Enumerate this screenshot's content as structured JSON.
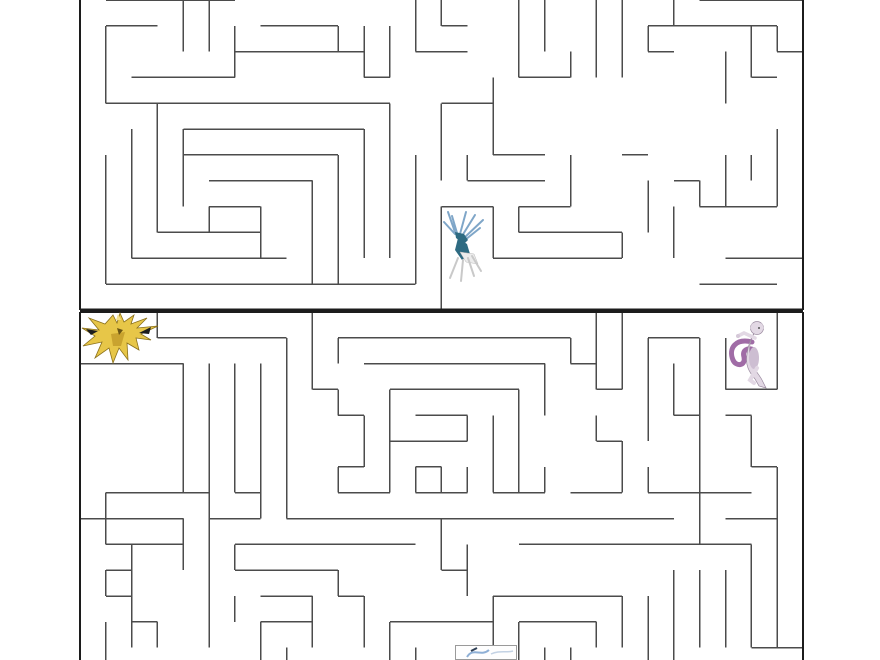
{
  "page": {
    "description": "Pokemon maze puzzle worksheet, two mazes stacked vertically, cropped at top and bottom",
    "background_color": "#ffffff",
    "wall_color": "#4b4b4b",
    "border_color": "#1c1c1c",
    "wall_width": 1.5,
    "border_width": 2.2
  },
  "maze_top": {
    "origin_x": 80,
    "origin_y": 0,
    "cell": 25.82,
    "cols": 28,
    "rows": 12,
    "note": "top edge of maze cut off by viewport",
    "borders": {
      "h": [
        [
          12,
          0,
          28
        ]
      ],
      "v": [
        [
          0,
          0,
          12
        ],
        [
          28,
          0,
          12
        ]
      ]
    },
    "h_walls": [
      [
        0,
        1,
        6
      ],
      [
        0,
        24,
        28
      ],
      [
        1,
        1,
        3
      ],
      [
        1,
        7,
        10
      ],
      [
        1,
        14,
        15
      ],
      [
        1,
        22,
        27
      ],
      [
        2,
        6,
        11
      ],
      [
        2,
        13,
        15
      ],
      [
        2,
        22,
        23
      ],
      [
        2,
        27,
        28
      ],
      [
        3,
        2,
        6
      ],
      [
        3,
        11,
        12
      ],
      [
        3,
        17,
        19
      ],
      [
        3,
        26,
        27
      ],
      [
        4,
        1,
        12
      ],
      [
        4,
        14,
        16
      ],
      [
        5,
        4,
        11
      ],
      [
        6,
        4,
        10
      ],
      [
        6,
        16,
        18
      ],
      [
        6,
        21,
        22
      ],
      [
        7,
        5,
        9
      ],
      [
        7,
        15,
        18
      ],
      [
        7,
        23,
        24
      ],
      [
        8,
        5,
        7
      ],
      [
        8,
        14,
        16
      ],
      [
        8,
        17,
        19
      ],
      [
        8,
        24,
        27
      ],
      [
        9,
        3,
        7
      ],
      [
        9,
        17,
        21
      ],
      [
        10,
        2,
        8
      ],
      [
        10,
        16,
        21
      ],
      [
        10,
        25,
        28
      ],
      [
        11,
        1,
        13
      ],
      [
        11,
        24,
        27
      ]
    ],
    "v_walls": [
      [
        1,
        1,
        4
      ],
      [
        1,
        6,
        11
      ],
      [
        2,
        5,
        10
      ],
      [
        3,
        4,
        9
      ],
      [
        4,
        0,
        2
      ],
      [
        4,
        5,
        8
      ],
      [
        5,
        0,
        2
      ],
      [
        5,
        8,
        9
      ],
      [
        6,
        1,
        3
      ],
      [
        7,
        8,
        10
      ],
      [
        9,
        7,
        11
      ],
      [
        10,
        1,
        2
      ],
      [
        10,
        6,
        11
      ],
      [
        11,
        1,
        3
      ],
      [
        11,
        5,
        10
      ],
      [
        12,
        1,
        3
      ],
      [
        12,
        4,
        10
      ],
      [
        13,
        0,
        2
      ],
      [
        13,
        6,
        11
      ],
      [
        14,
        0,
        1
      ],
      [
        14,
        4,
        7
      ],
      [
        14,
        8,
        12
      ],
      [
        15,
        6,
        7
      ],
      [
        16,
        3,
        6
      ],
      [
        16,
        8,
        10
      ],
      [
        17,
        0,
        3
      ],
      [
        17,
        8,
        9
      ],
      [
        18,
        0,
        2
      ],
      [
        19,
        2,
        3
      ],
      [
        19,
        6,
        8
      ],
      [
        20,
        0,
        3
      ],
      [
        21,
        0,
        3
      ],
      [
        21,
        9,
        10
      ],
      [
        22,
        1,
        2
      ],
      [
        22,
        7,
        9
      ],
      [
        23,
        0,
        1
      ],
      [
        23,
        8,
        10
      ],
      [
        24,
        7,
        8
      ],
      [
        25,
        2,
        4
      ],
      [
        25,
        6,
        8
      ],
      [
        26,
        1,
        3
      ],
      [
        26,
        6,
        7
      ],
      [
        27,
        1,
        2
      ],
      [
        27,
        5,
        8
      ]
    ]
  },
  "maze_bottom": {
    "origin_x": 80,
    "origin_y": 312,
    "cell": 25.82,
    "cols": 28,
    "rows": 13.6,
    "note": "bottom edge of maze cut off by viewport",
    "borders": {
      "h": [
        [
          0,
          0,
          28
        ]
      ],
      "v": [
        [
          0,
          0,
          13.6
        ],
        [
          28,
          0,
          13.6
        ]
      ]
    },
    "h_walls": [
      [
        1,
        3,
        8
      ],
      [
        1,
        10,
        19
      ],
      [
        1,
        22,
        24
      ],
      [
        2,
        0,
        4
      ],
      [
        2,
        11,
        18
      ],
      [
        2,
        19,
        20
      ],
      [
        3,
        9,
        10
      ],
      [
        3,
        12,
        17
      ],
      [
        3,
        20,
        21
      ],
      [
        3,
        25,
        27
      ],
      [
        4,
        10,
        11
      ],
      [
        4,
        13,
        15
      ],
      [
        4,
        23,
        24
      ],
      [
        4,
        25,
        26
      ],
      [
        5,
        12,
        15
      ],
      [
        5,
        20,
        21
      ],
      [
        6,
        10,
        11
      ],
      [
        6,
        13,
        14
      ],
      [
        6,
        26,
        27
      ],
      [
        7,
        1,
        5
      ],
      [
        7,
        6,
        7
      ],
      [
        7,
        10,
        12
      ],
      [
        7,
        13,
        15
      ],
      [
        7,
        16,
        18
      ],
      [
        7,
        19,
        21
      ],
      [
        7,
        22,
        26
      ],
      [
        8,
        0,
        4
      ],
      [
        8,
        5,
        7
      ],
      [
        8,
        8,
        23
      ],
      [
        8,
        25,
        27
      ],
      [
        9,
        1,
        4
      ],
      [
        9,
        6,
        13
      ],
      [
        9,
        17,
        26
      ],
      [
        10,
        1,
        2
      ],
      [
        10,
        6,
        10
      ],
      [
        10,
        14,
        15
      ],
      [
        11,
        1,
        2
      ],
      [
        11,
        7,
        9
      ],
      [
        11,
        10,
        11
      ],
      [
        11,
        16,
        21
      ],
      [
        12,
        2,
        3
      ],
      [
        12,
        7,
        9
      ],
      [
        12,
        12,
        16
      ],
      [
        12,
        17,
        20
      ],
      [
        13,
        26,
        28
      ]
    ],
    "v_walls": [
      [
        1,
        7,
        9
      ],
      [
        1,
        10,
        11
      ],
      [
        1,
        12,
        13.6
      ],
      [
        2,
        9,
        13
      ],
      [
        3,
        0,
        1
      ],
      [
        3,
        12,
        13
      ],
      [
        4,
        2,
        7
      ],
      [
        4,
        8,
        10
      ],
      [
        5,
        2,
        13
      ],
      [
        6,
        2,
        7
      ],
      [
        6,
        9,
        10
      ],
      [
        6,
        11,
        12
      ],
      [
        7,
        2,
        8
      ],
      [
        7,
        12,
        13.6
      ],
      [
        8,
        1,
        8
      ],
      [
        8,
        13,
        13.6
      ],
      [
        9,
        0,
        3
      ],
      [
        9,
        11,
        13
      ],
      [
        10,
        1,
        2
      ],
      [
        10,
        3,
        4
      ],
      [
        10,
        6,
        7
      ],
      [
        10,
        10,
        11
      ],
      [
        11,
        4,
        6
      ],
      [
        11,
        11,
        13
      ],
      [
        12,
        3,
        7
      ],
      [
        12,
        12,
        13.6
      ],
      [
        13,
        6,
        7
      ],
      [
        13,
        13,
        13.6
      ],
      [
        14,
        6,
        7
      ],
      [
        14,
        8,
        10
      ],
      [
        15,
        4,
        5
      ],
      [
        15,
        6,
        7
      ],
      [
        15,
        9,
        11
      ],
      [
        16,
        4,
        7
      ],
      [
        16,
        11,
        13.6
      ],
      [
        17,
        3,
        7
      ],
      [
        17,
        12,
        13.6
      ],
      [
        18,
        2,
        4
      ],
      [
        18,
        6,
        7
      ],
      [
        18,
        13,
        13.6
      ],
      [
        19,
        1,
        2
      ],
      [
        19,
        13,
        13.6
      ],
      [
        20,
        0,
        3
      ],
      [
        20,
        4,
        5
      ],
      [
        20,
        12,
        13
      ],
      [
        21,
        0,
        3
      ],
      [
        21,
        5,
        7
      ],
      [
        21,
        11,
        13
      ],
      [
        22,
        1,
        5
      ],
      [
        22,
        6,
        7
      ],
      [
        22,
        11,
        13.6
      ],
      [
        23,
        2,
        4
      ],
      [
        23,
        10,
        13.6
      ],
      [
        24,
        1,
        9
      ],
      [
        24,
        10,
        13
      ],
      [
        25,
        1,
        3
      ],
      [
        25,
        10,
        13
      ],
      [
        26,
        4,
        6
      ],
      [
        26,
        9,
        13
      ],
      [
        27,
        0,
        3
      ],
      [
        27,
        6,
        13
      ]
    ]
  },
  "sprites": {
    "xerneas": {
      "label": "xerneas-sprite",
      "x": 442,
      "y": 210,
      "w": 45,
      "h": 73,
      "colors": {
        "antler": "#7FA6C8",
        "body": "#2E6B82",
        "legs": "#c9c9c9",
        "rear": "#ECECEC"
      }
    },
    "zapdos": {
      "label": "zapdos-sprite",
      "x": 81,
      "y": 312,
      "w": 78,
      "h": 52,
      "colors": {
        "main": "#E7C648",
        "shade": "#c9a32f",
        "accent": "#1d1d1d",
        "outline": "#8a701c"
      }
    },
    "mewtwo": {
      "label": "mewtwo-sprite",
      "x": 724,
      "y": 320,
      "w": 55,
      "h": 71,
      "colors": {
        "body": "#E2D8E4",
        "belly": "#CDBED2",
        "tail": "#A06CA6",
        "outline": "#9b8ba0"
      }
    },
    "mystery": {
      "label": "mystery-sprite",
      "x": 455,
      "y": 645,
      "w": 62,
      "h": 15,
      "colors": {
        "frame": "#9a9a9a",
        "fill": "#fefefe",
        "mark": "#8FB0D6",
        "dark": "#2f3f55"
      }
    }
  }
}
